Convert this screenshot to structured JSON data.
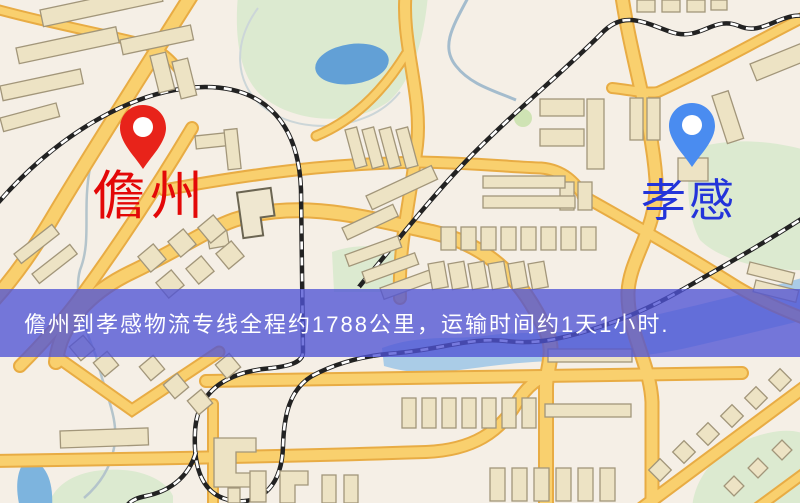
{
  "banner": {
    "text": "儋州到孝感物流专线全程约1788公里，运输时间约1天1小时.",
    "distance_text": "约1788公里",
    "duration_text": "约1天1小时",
    "background_color": "#4f53d5",
    "text_color": "#ffffff"
  },
  "markers": {
    "origin": {
      "label": "儋州",
      "label_color": "#e30808",
      "pin_color": "#e8231a",
      "pin_icon": "map-pin"
    },
    "destination": {
      "label": "孝感",
      "label_color": "#2334da",
      "pin_color": "#4a8cf0",
      "pin_icon": "map-pin"
    }
  },
  "map_colors": {
    "background": "#f5efe6",
    "road_fill": "#f9d06e",
    "road_casing": "#e8ac44",
    "park": "#dcead0",
    "river": "#9cc6e6",
    "lake": "#62a0d6",
    "building_fill": "#ede3c4",
    "building_outline": "#a2967a",
    "railway": "#222222"
  }
}
